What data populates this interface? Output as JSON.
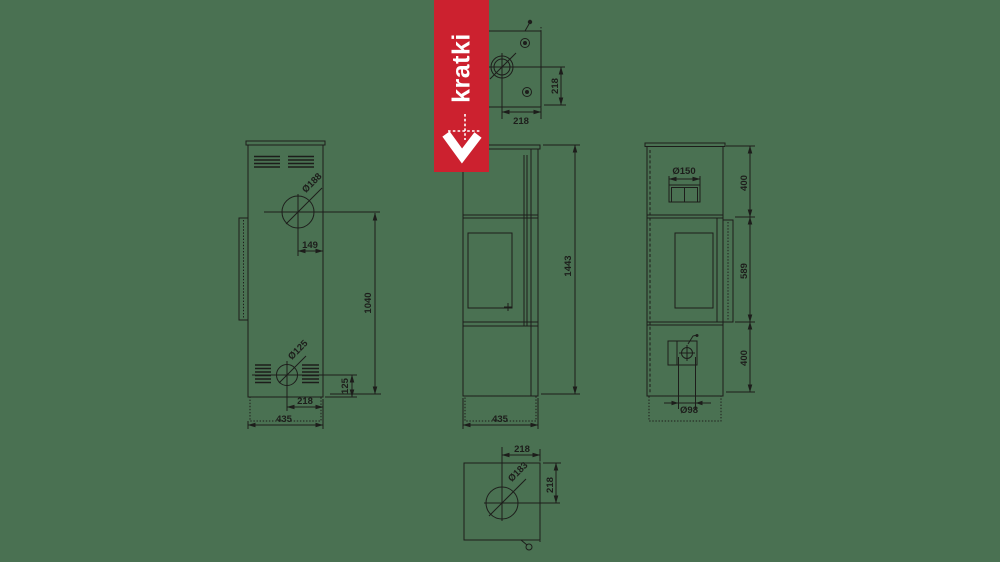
{
  "colors": {
    "background": "#4a7152",
    "line": "#1d1d1b",
    "brand-red": "#cc212f",
    "logo-white": "#ffffff"
  },
  "logo": {
    "brand": "kratki"
  },
  "top_view": {
    "width_dim": "218",
    "depth_dim": "218"
  },
  "rear_view": {
    "flue_diameter": "Ø188",
    "flue_offset": "149",
    "flue_to_floor": "1040",
    "inlet_diameter": "Ø125",
    "inlet_bottom_offset": "125",
    "inlet_side_offset": "218",
    "width": "435"
  },
  "front_view": {
    "height": "1443",
    "width": "435"
  },
  "side_view": {
    "flue_diameter": "Ø150",
    "top_section": "400",
    "middle_section": "589",
    "bottom_section": "400",
    "inlet_diameter": "Ø98"
  },
  "bottom_view": {
    "hole_diameter": "Ø183",
    "offset_x": "218",
    "offset_y": "218"
  }
}
